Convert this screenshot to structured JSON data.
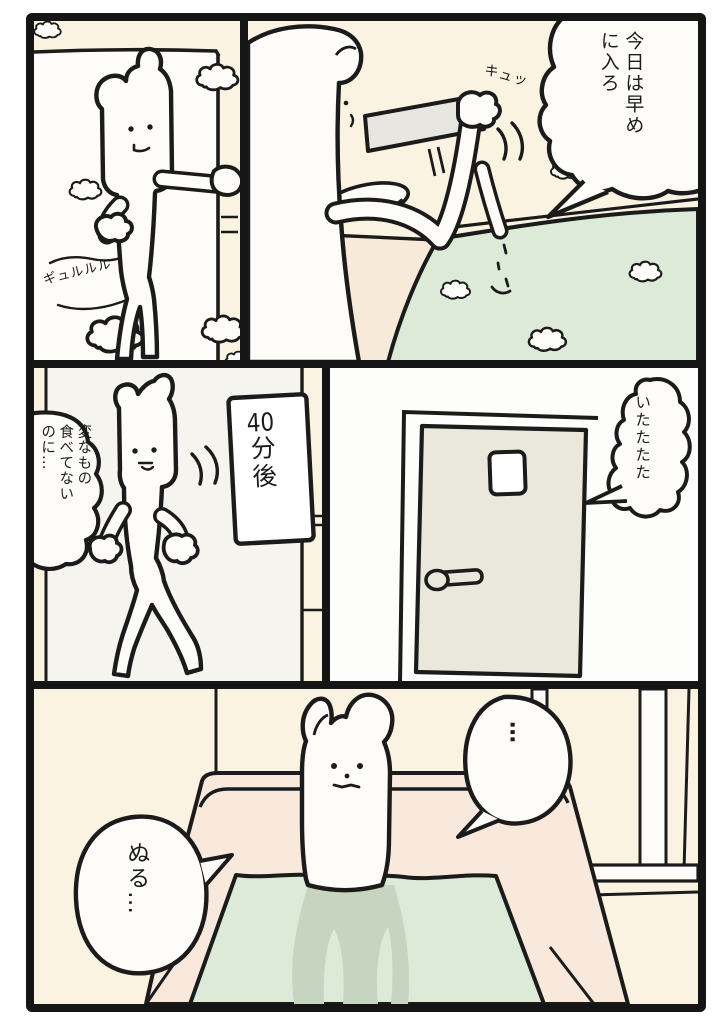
{
  "comic": {
    "panel1": {
      "sfx_stomach_growl": "ギュルルル"
    },
    "panel2": {
      "speech_bubble": "今日は早め\nに入ろ",
      "sfx_knob_squeak": "キュッ"
    },
    "panel3": {
      "speech_bubble": "変なもの\n食べてない\nのに…",
      "caption_number": "40",
      "caption_suffix": "分後"
    },
    "panel4": {
      "speech_bubble": "いたたたた"
    },
    "panel5": {
      "speech_bubble_ellipsis": "…",
      "speech_bubble_lukewarm": "ぬる…"
    }
  },
  "colors": {
    "ink": "#1b1b1b",
    "panel_border": "#151515",
    "wall_cream": "#faf3e1",
    "white": "#fdfcf8",
    "bath_water_green": "#dcead7",
    "underwater_shadow": "#c6d4c0",
    "tub_rim_pink": "#f8e9dc",
    "door_gray": "#e9e8db",
    "shelf_gray": "#e7e6e1",
    "panel3_bg": "#f6f4ee"
  }
}
